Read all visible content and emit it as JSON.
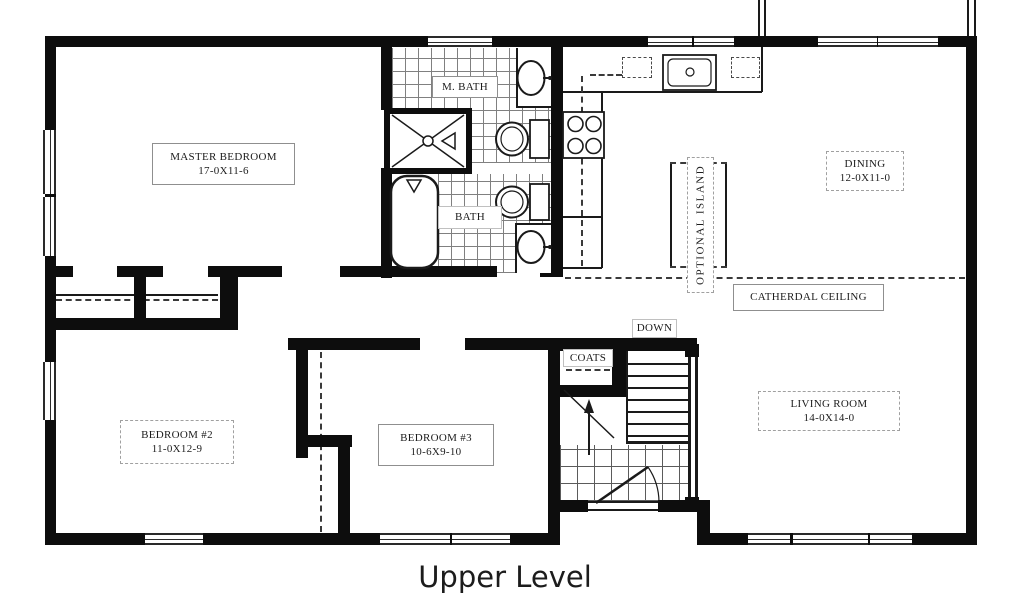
{
  "title": "Upper Level",
  "rooms": {
    "master_bedroom": {
      "name": "MASTER BEDROOM",
      "dims": "17-0X11-6"
    },
    "dining": {
      "name": "DINING",
      "dims": "12-0X11-0"
    },
    "living_room": {
      "name": "LIVING ROOM",
      "dims": "14-0X14-0"
    },
    "bedroom_2": {
      "name": "BEDROOM #2",
      "dims": "11-0X12-9"
    },
    "bedroom_3": {
      "name": "BEDROOM #3",
      "dims": "10-6X9-10"
    },
    "master_bath": {
      "name": "M. BATH"
    },
    "bath": {
      "name": "BATH"
    },
    "coats": {
      "name": "COATS"
    },
    "stairs": {
      "name": "DOWN"
    },
    "optional_island": {
      "name": "OPTIONAL ISLAND"
    },
    "cathedral_ceiling": {
      "name": "CATHERDAL CEILING"
    }
  },
  "fixtures": [
    "shower-icon",
    "bathtub-icon",
    "toilet-icon",
    "sink-icon",
    "kitchen-sink-icon",
    "stove-icon",
    "stairs-icon",
    "entry-door-icon",
    "railing-icon",
    "closet-rod-icon"
  ],
  "colors": {
    "wall": "#0d0d0d",
    "line": "#1a1a1a",
    "background": "#ffffff"
  }
}
